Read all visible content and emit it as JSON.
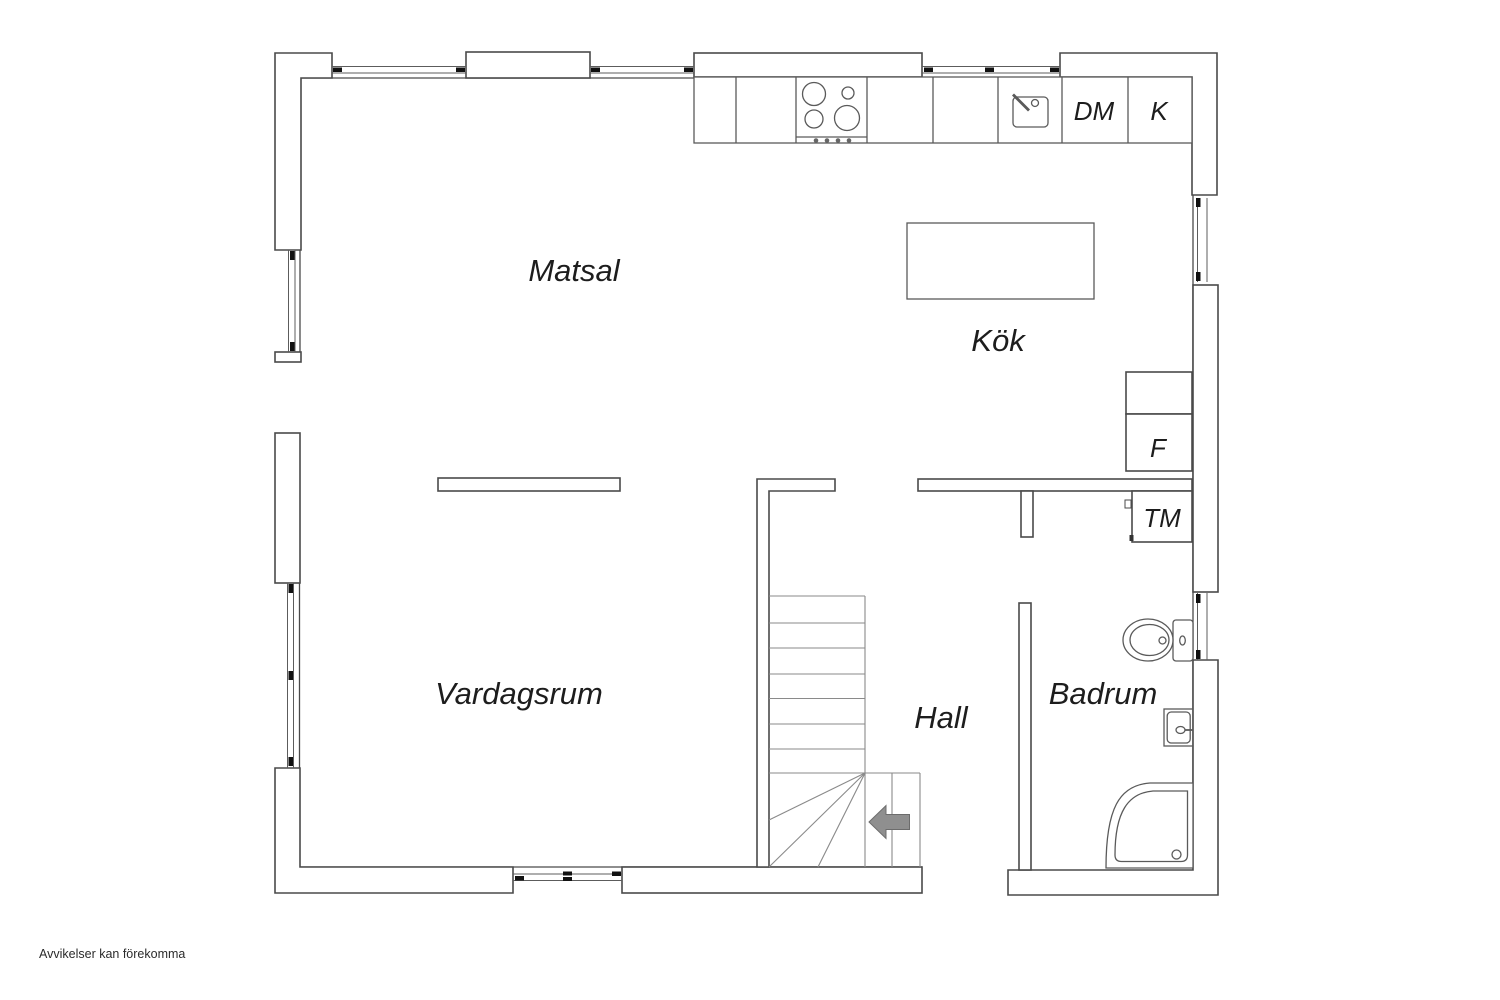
{
  "floorplan": {
    "rooms": {
      "matsal": {
        "label": "Matsal"
      },
      "kok": {
        "label": "Kök"
      },
      "vardagsrum": {
        "label": "Vardagsrum"
      },
      "hall": {
        "label": "Hall"
      },
      "badrum": {
        "label": "Badrum"
      }
    },
    "appliances": {
      "dishwasher": {
        "label": "DM"
      },
      "fridge": {
        "label": "K"
      },
      "freezer": {
        "label": "F"
      },
      "washing_machine": {
        "label": "TM"
      }
    },
    "disclaimer": "Avvikelser kan förekomma",
    "colors": {
      "wall_line": "#4a4a4a",
      "fixture_line": "#5a5a5a",
      "stair_line": "#8a8a8a",
      "window_tick": "#111111",
      "arrow_fill": "#8f8f8f",
      "text": "#1d1d1d"
    }
  }
}
